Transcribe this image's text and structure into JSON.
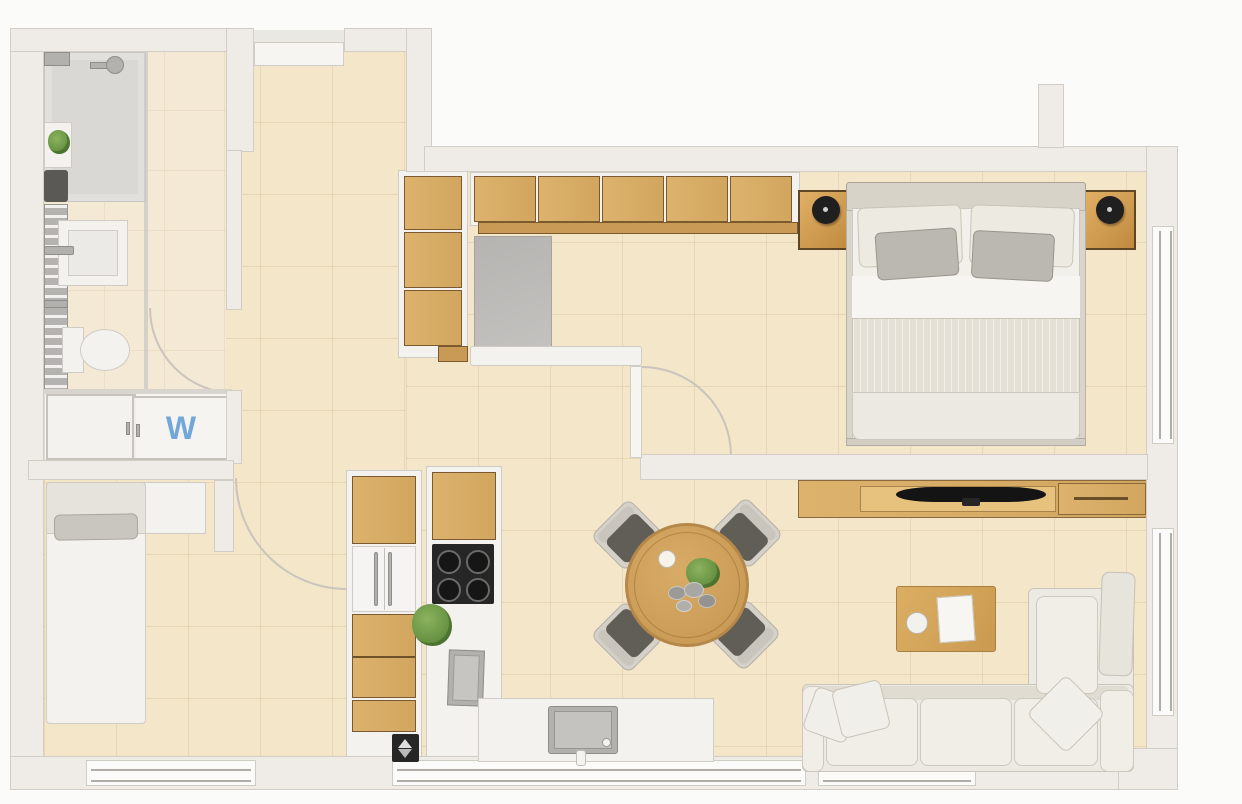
{
  "plan_title": "studio-apartment-floor-plan",
  "laundry": {
    "label": "W"
  },
  "palette": {
    "background": "#fbfbfa",
    "wall": "#efece7",
    "wall_border": "#d2cec6",
    "floor": "#f4e6c9",
    "floor_light": "#f4e9d4",
    "closet_floor": "#f8f7f4",
    "wood": "#dcb26d",
    "wood_mid": "#c89a55",
    "wood_dark": "#7a5a2e",
    "fabric": "#eceae2",
    "fabric_border": "#c8c4ba",
    "gray_fixture": "#b2b1ae",
    "dark": "#262626",
    "glass": "#c9c8c5",
    "accent_blue": "#5b9bd5",
    "plant": "#5e8b3c"
  },
  "rooms": [
    {
      "name": "bathroom",
      "items": [
        "shower",
        "shower-head",
        "glass-partition",
        "washbasin",
        "toilet",
        "towel-radiator",
        "shelf-plant",
        "door-swing"
      ]
    },
    {
      "name": "laundry-closet",
      "items": [
        "sliding-door-left",
        "sliding-door-right",
        "washing-machine"
      ]
    },
    {
      "name": "entry",
      "items": [
        "entry-door"
      ]
    },
    {
      "name": "hallway",
      "items": [
        "tall-wardrobe",
        "wardrobe-cabinet-row",
        "closet-niche",
        "bench",
        "bedroom-door"
      ]
    },
    {
      "name": "study-bedroom",
      "items": [
        "single-bed",
        "desk",
        "door-swing"
      ]
    },
    {
      "name": "kitchen",
      "items": [
        "tall-cabinet-column",
        "refrigerator",
        "oven",
        "cooktop",
        "column-sink",
        "peninsula-counter",
        "peninsula-sink",
        "plant"
      ]
    },
    {
      "name": "dining-area",
      "items": [
        "round-table",
        "dining-chair",
        "dining-chair",
        "dining-chair",
        "dining-chair",
        "cup",
        "plant",
        "stones"
      ]
    },
    {
      "name": "bedroom",
      "items": [
        "double-bed",
        "headboard",
        "pillow",
        "pillow",
        "pillow",
        "pillow",
        "nightstand-left",
        "nightstand-right",
        "table-lamp",
        "table-lamp",
        "window"
      ]
    },
    {
      "name": "living-room",
      "items": [
        "tv-console",
        "tv",
        "coffee-table",
        "sofa",
        "chaise-lounge",
        "throw-pillows",
        "window"
      ]
    }
  ]
}
